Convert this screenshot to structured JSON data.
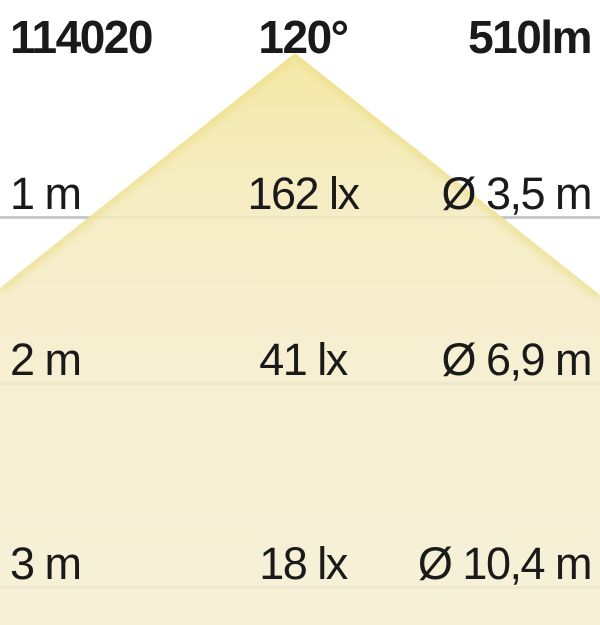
{
  "header": {
    "article_number": "114020",
    "beam_angle": "120°",
    "luminous_flux": "510lm"
  },
  "rows": [
    {
      "distance": "1 m",
      "illuminance": "162 lx",
      "diameter": "Ø 3,5 m"
    },
    {
      "distance": "2 m",
      "illuminance": "41 lx",
      "diameter": "Ø 6,9 m"
    },
    {
      "distance": "3 m",
      "illuminance": "18 lx",
      "diameter": "Ø 10,4 m"
    }
  ],
  "colors": {
    "beam_apex": "#f2e596",
    "beam_bottom": "#f5edd0",
    "distance_line": "#c6cac8",
    "text": "#1a1a1a",
    "background": "#ffffff"
  },
  "chart_data": {
    "type": "table",
    "title": "LED beam light-cone diagram",
    "article_number": "114020",
    "beam_angle_deg": 120,
    "luminous_flux_lm": 510,
    "columns": [
      "distance_m",
      "illuminance_lx",
      "beam_diameter_m"
    ],
    "rows": [
      [
        1,
        162,
        3.5
      ],
      [
        2,
        41,
        6.9
      ],
      [
        3,
        18,
        10.4
      ]
    ]
  }
}
